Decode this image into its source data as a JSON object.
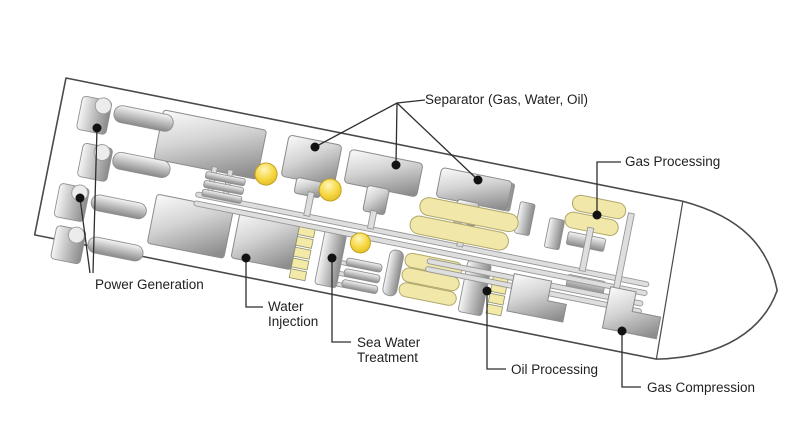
{
  "figure": {
    "description_labels": {
      "separator": "Separator (Gas, Water, Oil)",
      "gas_processing": "Gas Processing",
      "power_generation": "Power Generation",
      "water_injection": {
        "line1": "Water",
        "line2": "Injection"
      },
      "sea_water_treatment": {
        "line1": "Sea Water",
        "line2": "Treatment"
      },
      "oil_processing": "Oil Processing",
      "gas_compression": "Gas Compression"
    },
    "colors": {
      "background": "#ffffff",
      "hull_outline": "#4a4a4a",
      "equipment_metal_light": "#f4f4f4",
      "equipment_metal_dark": "#8e8e8e",
      "process_yellow": "#f0e7a9",
      "sphere_yellow": "#f3d53a",
      "leader_line": "#2e2e2e",
      "label_text": "#222222"
    }
  }
}
